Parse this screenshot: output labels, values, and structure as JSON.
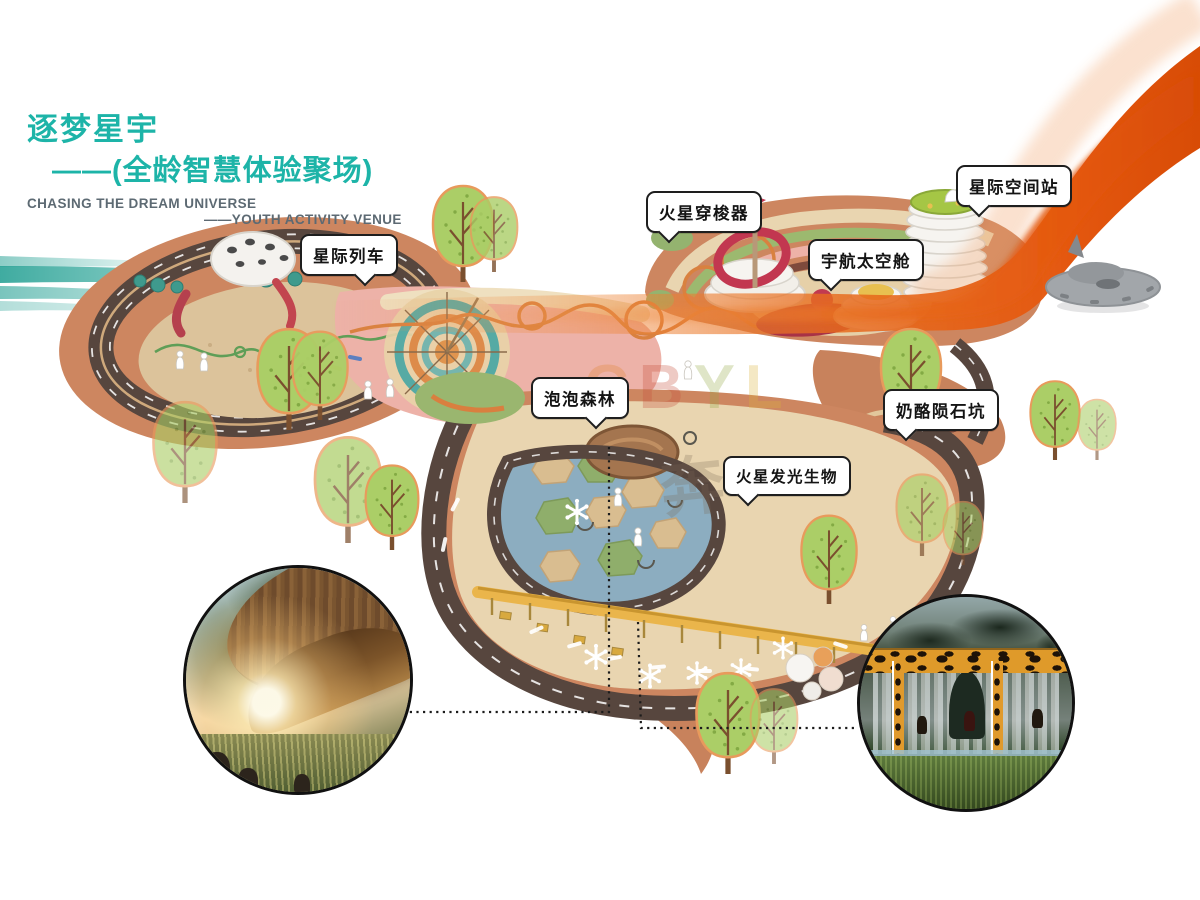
{
  "title": {
    "cn_line1": "逐梦星宇",
    "cn_line2": "——(全龄智慧体验聚场)",
    "en_line1": "CHASING THE DREAM UNIVERSE",
    "en_line2": "——YOUTH ACTIVITY VENUE"
  },
  "callouts": [
    {
      "id": "star-train",
      "label": "星际列车"
    },
    {
      "id": "mars-shuttle",
      "label": "火星穿梭器"
    },
    {
      "id": "star-space-station",
      "label": "星际空间站"
    },
    {
      "id": "astronaut-capsule",
      "label": "宇航太空舱"
    },
    {
      "id": "bubble-forest",
      "label": "泡泡森林"
    },
    {
      "id": "mars-glowing-creature",
      "label": "火星发光生物"
    },
    {
      "id": "cheese-meteor-crater",
      "label": "奶酪陨石坑"
    }
  ],
  "watermark": {
    "letters": [
      "C",
      "B",
      "Y",
      "L"
    ],
    "seal": "奔"
  },
  "colors": {
    "title_teal": "#1db4a8",
    "subtitle_gray": "#5d6a73",
    "ribbon_orange": "#e4570f",
    "swoosh_teal": "#2fa79b",
    "plan_salmon": "#cd8660",
    "road_brown": "#57463e",
    "sand_tan": "#dcc39b",
    "plaza_pink": "#edb2a8",
    "pond_blue": "#8cadc0",
    "lawn_green": "#92b06c",
    "accent_red": "#b03a4c",
    "canopy_gold": "#e9b54d"
  }
}
